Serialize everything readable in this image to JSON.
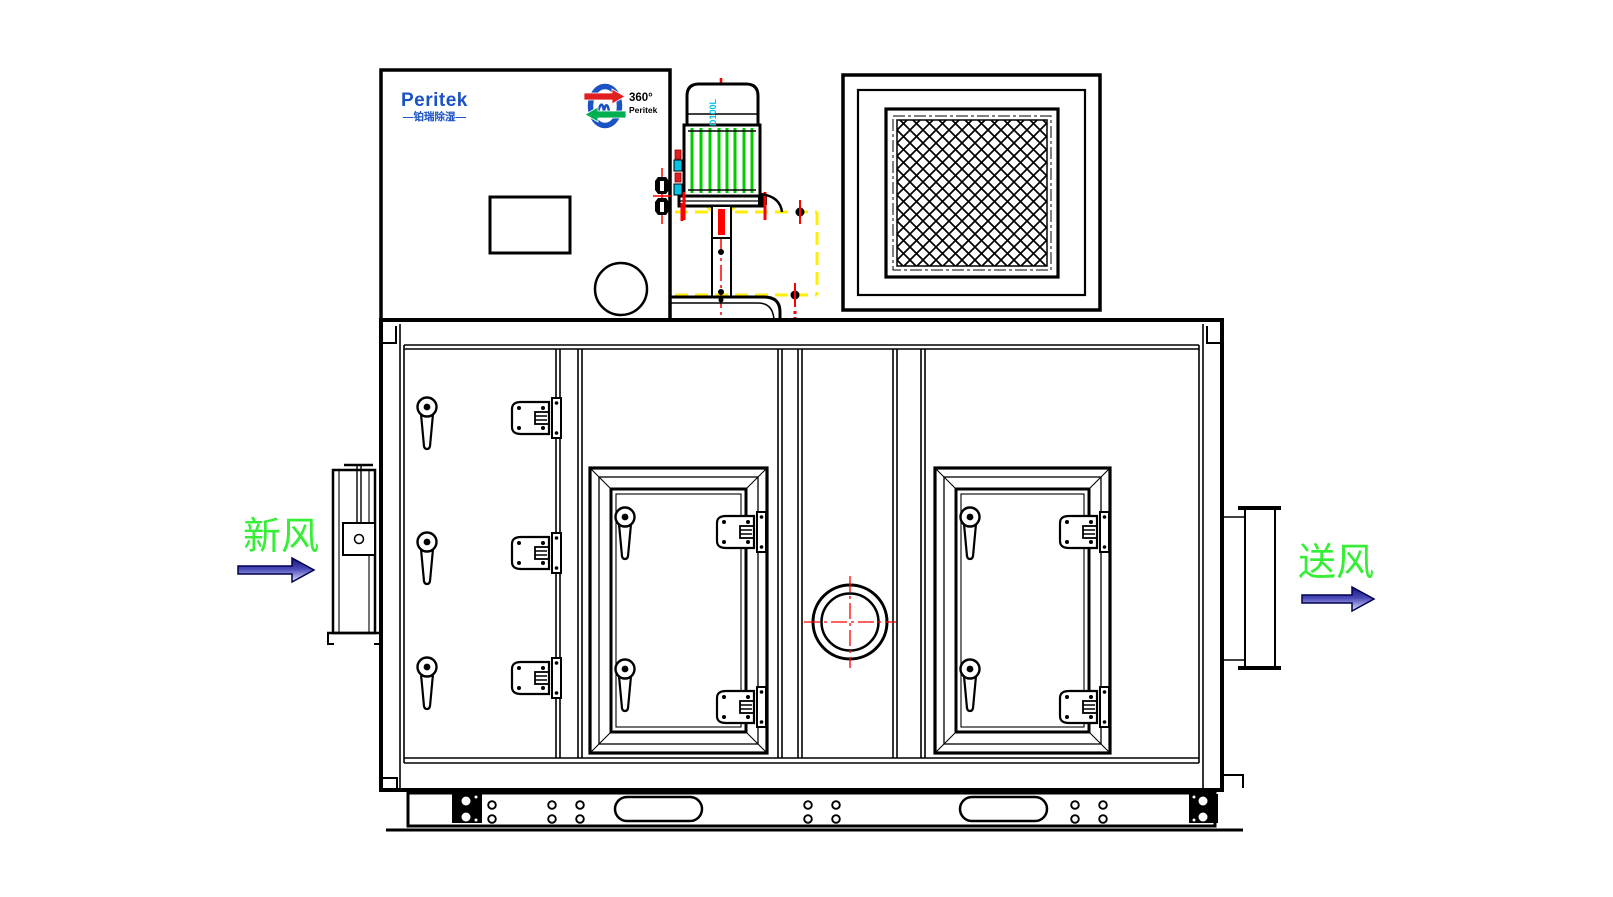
{
  "logo": {
    "brand": "Peritek",
    "subtitle": "—铂瑞除湿—"
  },
  "rotor_logo": {
    "degrees": "360°",
    "brand": "Peritek"
  },
  "motor": {
    "model_label": "D100L"
  },
  "flow_labels": {
    "fresh_air": "新风",
    "supply_air": "送风"
  },
  "colors": {
    "line": "#000000",
    "logo_blue": "#1B52C4",
    "stripe_green": "#00CC00",
    "label_green": "#35EE35",
    "centerline_red": "#FF0000",
    "dash_yellow": "#FFEE00",
    "accent_cyan": "#00C4E8",
    "arrow_dark": "#15157E",
    "arrow_light": "#E2E2FF"
  }
}
